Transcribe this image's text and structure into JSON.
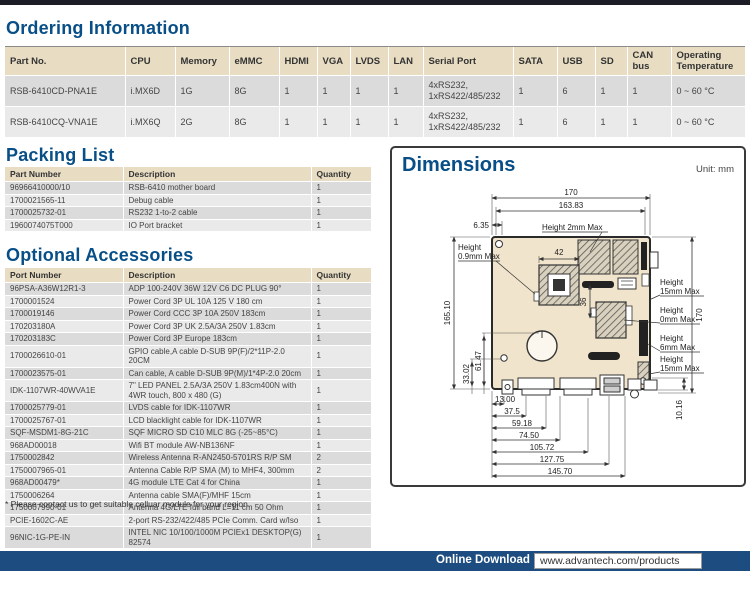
{
  "colors": {
    "accent_blue": "#084f87",
    "footer_navy": "#1d4d80",
    "table_header_beige": "#e8ddc3",
    "board_beige": "#f0e4cc"
  },
  "ordering": {
    "title": "Ordering Information",
    "headers": [
      "Part No.",
      "CPU",
      "Memory",
      "eMMC",
      "HDMI",
      "VGA",
      "LVDS",
      "LAN",
      "Serial Port",
      "SATA",
      "USB",
      "SD",
      "CAN bus",
      "Operating Temperature"
    ],
    "rows": [
      [
        "RSB-6410CD-PNA1E",
        "i.MX6D",
        "1G",
        "8G",
        "1",
        "1",
        "1",
        "1",
        "4xRS232, 1xRS422/485/232",
        "1",
        "6",
        "1",
        "1",
        "0 ~ 60 °C"
      ],
      [
        "RSB-6410CQ-VNA1E",
        "i.MX6Q",
        "2G",
        "8G",
        "1",
        "1",
        "1",
        "1",
        "4xRS232, 1xRS422/485/232",
        "1",
        "6",
        "1",
        "1",
        "0 ~ 60 °C"
      ]
    ]
  },
  "packing": {
    "title": "Packing List",
    "headers": [
      "Part Number",
      "Description",
      "Quantity"
    ],
    "rows": [
      [
        "96966410000/10",
        "RSB-6410 mother board",
        "1"
      ],
      [
        "1700021565-11",
        "Debug cable",
        "1"
      ],
      [
        "1700025732-01",
        "RS232 1-to-2 cable",
        "1"
      ],
      [
        "1960074075T000",
        "IO Port bracket",
        "1"
      ]
    ]
  },
  "accessories": {
    "title": "Optional Accessories",
    "headers": [
      "Port Number",
      "Description",
      "Quantity"
    ],
    "rows": [
      [
        "96PSA-A36W12R1-3",
        "ADP 100-240V 36W 12V C6 DC PLUG 90°",
        "1"
      ],
      [
        "1700001524",
        "Power Cord 3P UL 10A 125 V 180 cm",
        "1"
      ],
      [
        "1700019146",
        "Power Cord CCC 3P 10A 250V 183cm",
        "1"
      ],
      [
        "170203180A",
        "Power Cord 3P UK 2.5A/3A 250V 1.83cm",
        "1"
      ],
      [
        "170203183C",
        "Power Cord 3P Europe 183cm",
        "1"
      ],
      [
        "1700026610-01",
        "GPIO cable,A cable D-SUB 9P(F)/2*11P-2.0 20CM",
        "1"
      ],
      [
        "1700023575-01",
        "Can cable, A cable D-SUB 9P(M)/1*4P-2.0 20cm",
        "1"
      ],
      [
        "IDK-1107WR-40WVA1E",
        "7\" LED PANEL 2.5A/3A 250V 1.83cm400N with 4WR touch, 800 x 480 (G)",
        "1"
      ],
      [
        "1700025779-01",
        "LVDS cable for IDK-1107WR",
        "1"
      ],
      [
        "1700025767-01",
        "LCD blacklight cable for IDK-1107WR",
        "1"
      ],
      [
        "SQF-MSDM1-8G-21C",
        "SQF MICRO SD C10 MLC 8G (-25~85°C)",
        "1"
      ],
      [
        "968AD00018",
        "Wifi BT module AW-NB136NF",
        "1"
      ],
      [
        "1750002842",
        "Wireless Antenna R-AN2450-5701RS R/P SM",
        "2"
      ],
      [
        "1750007965-01",
        "Antenna Cable R/P SMA (M) to MHF4, 300mm",
        "2"
      ],
      [
        "968AD00479*",
        "4G module LTE Cat 4 for China",
        "1"
      ],
      [
        "1750006264",
        "Antenna cable SMA(F)/MHF 15cm",
        "1"
      ],
      [
        "1750007990-01",
        "Antenna 4G/LTE full band L=11 cm 50 Ohm",
        "1"
      ],
      [
        "PCIE-1602C-AE",
        "2-port RS-232/422/485 PCIe Comm. Card w/Iso",
        "1"
      ],
      [
        "96NIC-1G-PE-IN",
        "INTEL NIC 10/100/1000M PCIEx1 DESKTOP(G) 82574",
        "1"
      ]
    ],
    "footnote": "* Please contact us to get suitable celluar module for your region."
  },
  "dimensions": {
    "title": "Dimensions",
    "unit": "Unit: mm",
    "labels": {
      "top170": "170",
      "top16383": "163.83",
      "top635": "6.35",
      "h2mm": "Height 2mm Max",
      "h09a": "Height",
      "h09b": "0.9mm Max",
      "left16510": "165.10",
      "left3302": "33.02",
      "left6147": "61.47",
      "cpu42": "42",
      "mem36": "36",
      "right170": "170",
      "h15a1": "Height",
      "h15a2": "15mm Max",
      "h0a1": "Height",
      "h0a2": "0mm Max",
      "h6a1": "Height",
      "h6a2": "6mm Max",
      "h15b1": "Height",
      "h15b2": "15mm Max",
      "r1016": "10.16",
      "b1300": "13.00",
      "b375": "37.5",
      "b5918": "59.18",
      "b7450": "74.50",
      "b10572": "105.72",
      "b12775": "127.75",
      "b14570": "145.70"
    }
  },
  "footer": {
    "label": "Online Download",
    "url": "www.advantech.com/products"
  }
}
